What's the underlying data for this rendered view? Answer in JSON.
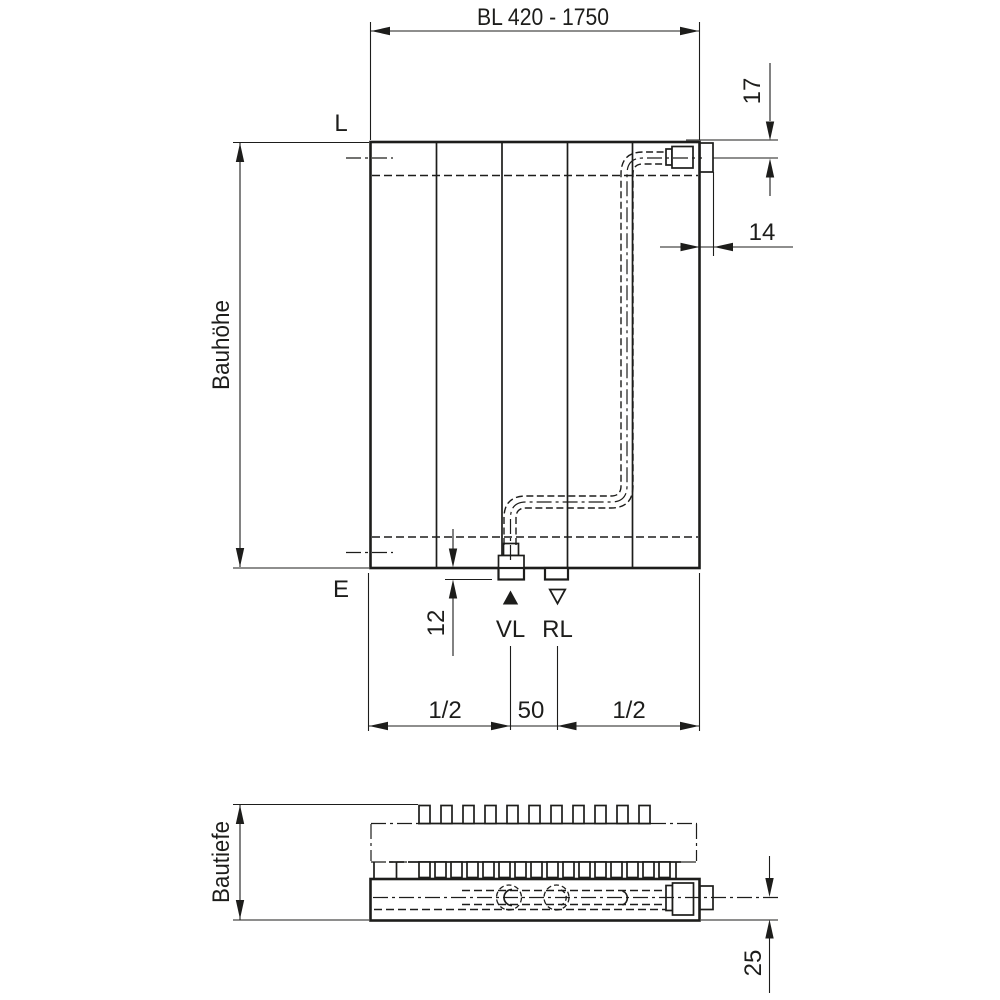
{
  "colors": {
    "line": "#1d1d1b",
    "background": "#ffffff"
  },
  "front_view": {
    "length_dim": "BL 420 - 1750",
    "top_line_label": "L",
    "bottom_line_label": "E",
    "height_label": "Bauhöhe",
    "top_connection_offset": "17",
    "side_connection_offset": "14",
    "stub_protrusion": "12",
    "supply_label": "VL",
    "return_label": "RL",
    "bottom_left_dim": "1/2",
    "bottom_center_dim": "50",
    "bottom_right_dim": "1/2"
  },
  "plan_view": {
    "depth_label": "Bautiefe",
    "rear_connection_offset": "25"
  }
}
